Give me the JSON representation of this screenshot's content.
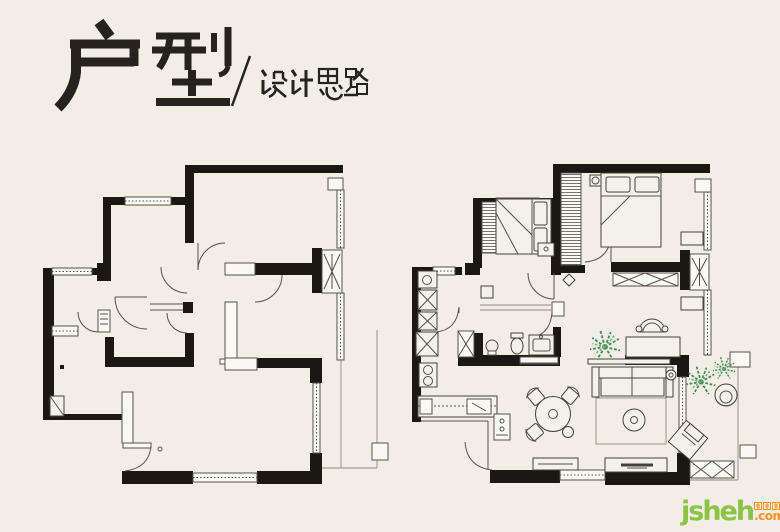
{
  "header": {
    "title": "户型",
    "separator": "/",
    "subtitle": "设计思路"
  },
  "plans": {
    "left": {
      "content": "original floor plan (unfurnished)"
    },
    "right": {
      "content": "design layout floor plan (furnished)"
    }
  },
  "watermark": {
    "brand": "jsheh",
    "suffix": ".com",
    "brand_cn": "聚设汇",
    "brand_color": "#8bc347",
    "suffix_color": "#f7941e"
  },
  "palette": {
    "background": "#f2eee5",
    "ink": "#26231e",
    "wall": "#1b1813",
    "thin_line": "#55504a",
    "plant_green": "#3e8a52"
  }
}
